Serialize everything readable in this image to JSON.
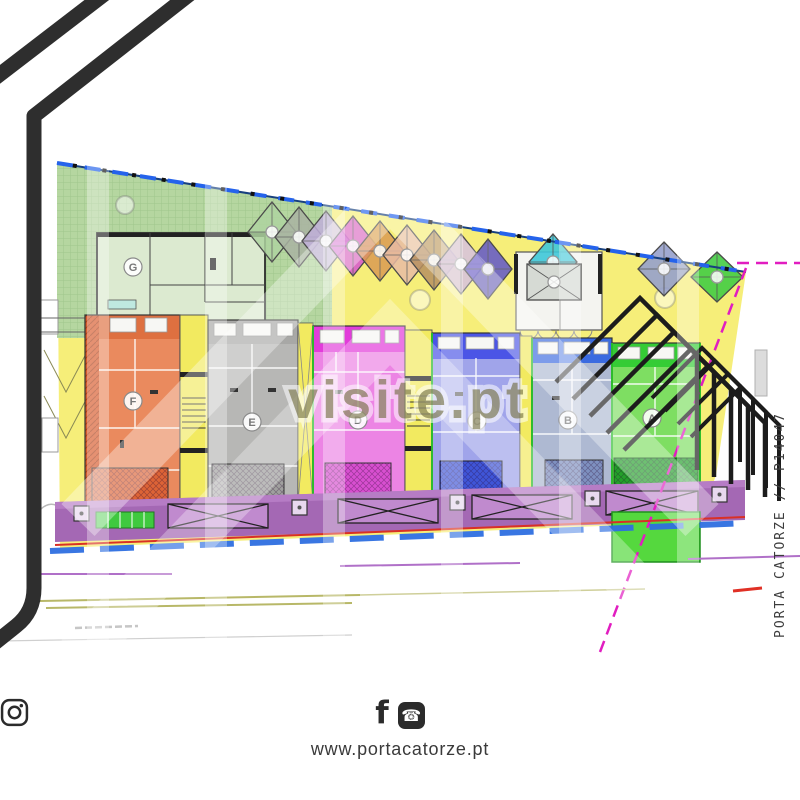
{
  "branding": {
    "watermark_text": "visite.pt",
    "project_ref": "PORTA CATORZE // P14047",
    "website": "www.portacatorze.pt",
    "footer_icons": [
      "facebook-icon",
      "phone-icon",
      "instagram-icon"
    ]
  },
  "plan": {
    "units": [
      {
        "label": "G",
        "color": "#dcead0",
        "band": "#c9ddb4"
      },
      {
        "label": "F",
        "color": "#ea8a5e",
        "band": "#de7040"
      },
      {
        "label": "E",
        "color": "#b7b7b5",
        "band": "#a8a8a6"
      },
      {
        "label": "D",
        "color": "#ec84e4",
        "band": "#e23cda"
      },
      {
        "label": "C",
        "color": "#a0a4ea",
        "band": "#4b55e6"
      },
      {
        "label": "B",
        "color": "#aeb9d2",
        "band": "#3a6ae0"
      },
      {
        "label": "A",
        "color": "#7ede62",
        "band": "#35cc35"
      }
    ],
    "canopy_colors": [
      "#aed3a0",
      "#a9b3a2",
      "#bfaed9",
      "#d655cf",
      "#d99a52",
      "#e7bba4",
      "#b68f60",
      "#bfa0c4",
      "#5f55c9",
      "#3ec8d8",
      "#96a0cc",
      "#44cc44"
    ],
    "site_colors": {
      "lawn": "#b5d6a0",
      "yard": "#f6ee79",
      "walkway": "#a468b4",
      "boundary_top": "#2563eb",
      "boundary_right": "#e11dc0",
      "curb": "#d93025",
      "road_line": "#2e6fe0"
    }
  }
}
